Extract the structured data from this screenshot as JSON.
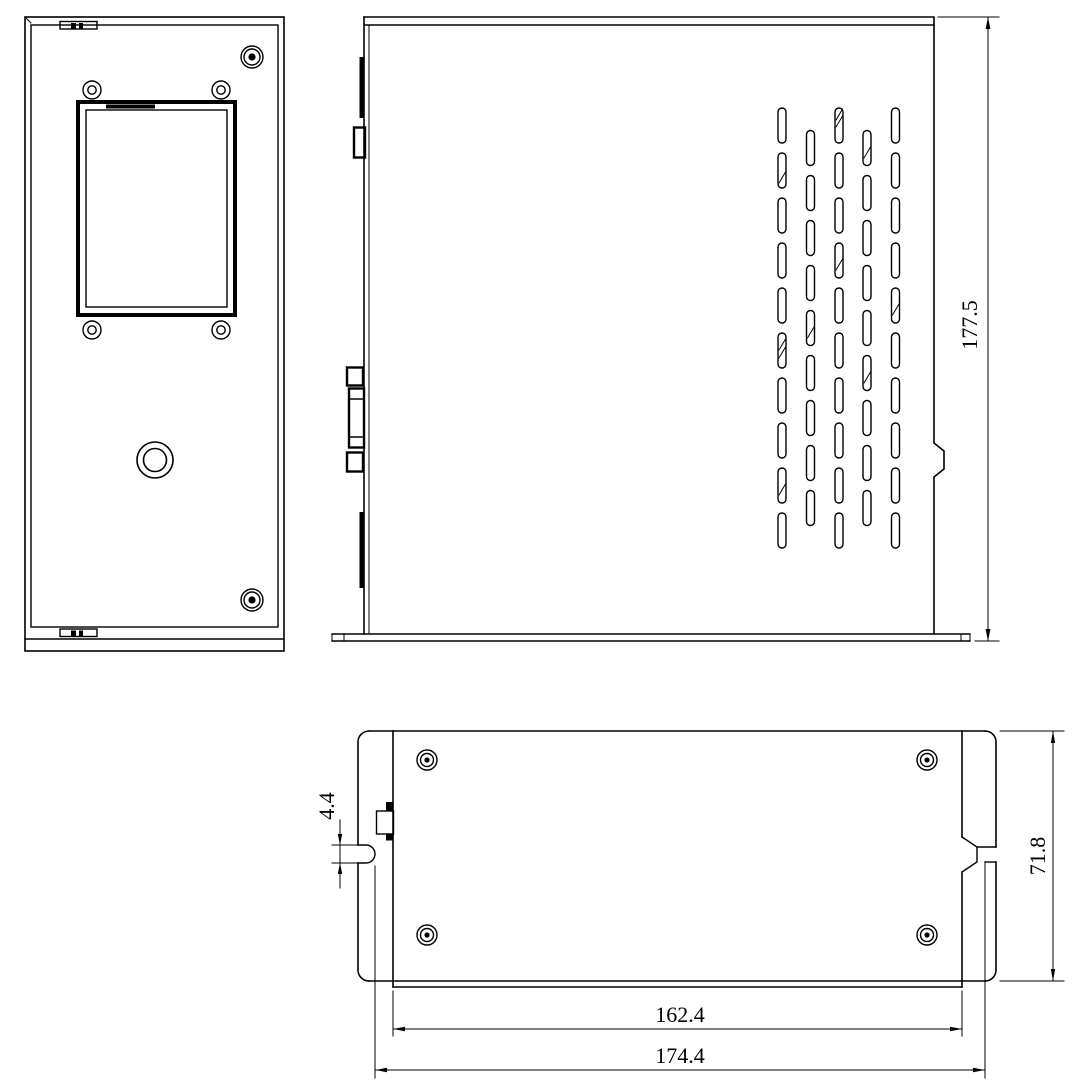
{
  "colors": {
    "background": "#ffffff",
    "line": "#000000"
  },
  "views": {
    "side": {
      "dim_height": "177.5"
    },
    "bottom": {
      "dim_slot": "4.4",
      "dim_depth": "71.8",
      "dim_body_width": "162.4",
      "dim_overall_width": "174.4"
    }
  }
}
